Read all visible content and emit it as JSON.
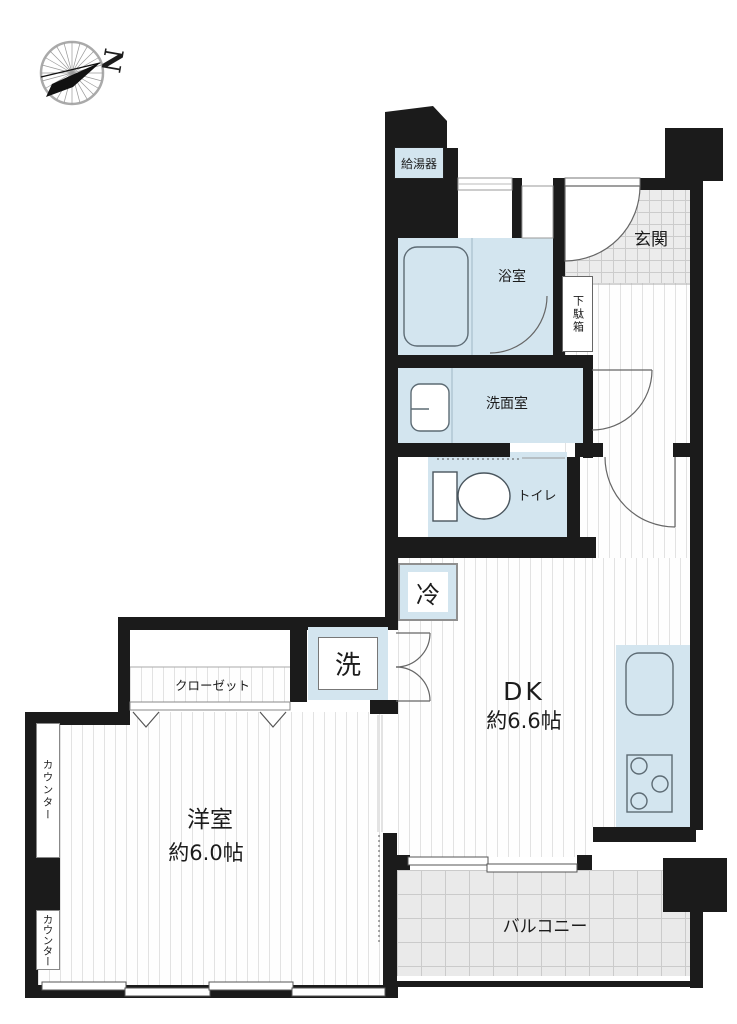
{
  "title": "apartment-floor-plan",
  "compass": {
    "north_label": "N"
  },
  "labels": {
    "water_heater": "給湯器",
    "entrance": "玄関",
    "shoe_box": "下駄箱",
    "bathroom": "浴室",
    "washroom": "洗面室",
    "toilet": "トイレ",
    "refrigerator": "冷",
    "washer": "洗",
    "dk_name": "DK",
    "dk_size": "約6.6帖",
    "closet": "クローゼット",
    "counter_upper": "カウンター",
    "counter_lower": "カウンター",
    "western_room_name": "洋室",
    "western_room_size": "約6.0帖",
    "balcony": "バルコニー"
  },
  "colors": {
    "wall": "#1b1b1b",
    "water-blue": "#d3e5ef",
    "tile": "#ececec",
    "balcony-tile": "#eaeaea"
  }
}
